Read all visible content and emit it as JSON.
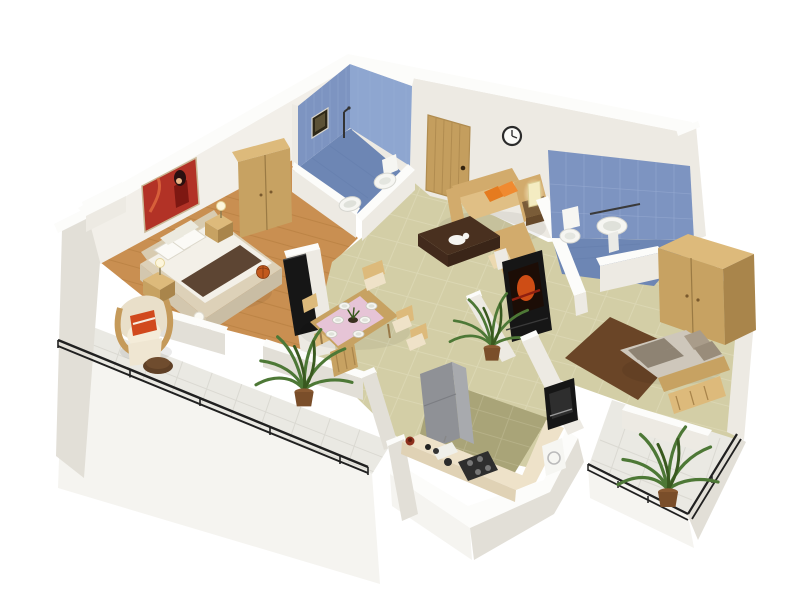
{
  "meta": {
    "type": "3d-isometric-floor-plan-render",
    "subject": "two-bedroom apartment 3D floor plan with balconies",
    "background": "#ffffff",
    "view": "isometric-from-south-east"
  },
  "palette": {
    "wall_top": "#fcfcfa",
    "wall_face": "#f2efe9",
    "wall_light": "#edeae3",
    "wall_mid": "#e2dfd7",
    "slab": "#f5f4f0",
    "blue_wall": "#7d94c1",
    "blue_wall_light": "#8ea6d0",
    "blue_floor": "#6d86b4",
    "blue_tile_line": "#9db0d6",
    "wood_floor": "#c98f51",
    "wood_line": "#b27c3e",
    "tile_floor": "#d3cea6",
    "tile_line": "#dfdbb9",
    "kitchen_floor": "#a9a478",
    "kitchen_line": "#b9b48c",
    "balcony_floor": "#eae9e3",
    "balcony_line": "#d8d6cf",
    "wood_furniture": "#c7a262",
    "wood_furniture_light": "#ddba7b",
    "wood_furniture_dark": "#a9854b",
    "door_wood": "#c49e5e",
    "sofa": "#d2ab6c",
    "sofa_light": "#e0bf85",
    "cream": "#efe2c8",
    "orange": "#e57b1f",
    "dark_table": "#49301f",
    "tv_black": "#161616",
    "tv_screen": "#e25417",
    "bed_linen": "#f3f0e8",
    "bed_runner": "#5d4533",
    "bed2_mattress": "#cec7bb",
    "bed2_cushion": "#8e8373",
    "rug_brown": "#6a4527",
    "plant_green": "#4d7836",
    "plant_dark": "#39591f",
    "railing": "#202020",
    "fridge_gray": "#8f9196",
    "counter_top": "#eee2c9",
    "white_fixture": "#f6f6f2",
    "poster_red": "#b23226",
    "pink_cloth": "#e6c4d6",
    "glow": "#fdf6dc"
  },
  "rooms": [
    {
      "id": "master-bedroom",
      "floor": "wooden-planks",
      "objects": [
        "double-bed",
        "white-linen",
        "brown-bed-runner",
        "four-pillows",
        "nightstand-left",
        "nightstand-right",
        "ball-table-lamps",
        "double-door-wardrobe",
        "red-wall-art",
        "tv-panel",
        "basketball",
        "floor-ball-lamp"
      ]
    },
    {
      "id": "bathroom-1",
      "walls": "blue-tile",
      "objects": [
        "toilet",
        "wash-basin-on-half-wall",
        "shower-fixture",
        "small-window",
        "half-walls"
      ]
    },
    {
      "id": "entrance-hall",
      "objects": [
        "wooden-entry-door",
        "wall-clock"
      ]
    },
    {
      "id": "living-room",
      "objects": [
        "l-shaped-beige-sofa",
        "two-orange-cushions",
        "cream-cushion",
        "dark-coffee-table",
        "white-cat-on-table",
        "side-table",
        "glowing-lamp",
        "black-tv-unit-orange-screen",
        "houseplant"
      ]
    },
    {
      "id": "dining-room",
      "objects": [
        "wooden-dining-table",
        "pink-table-runner",
        "six-chairs",
        "six-place-settings",
        "dark-centerpiece",
        "houseplant"
      ]
    },
    {
      "id": "kitchen",
      "floor": "olive-tile",
      "objects": [
        "gray-refrigerator",
        "l-shaped-counter",
        "gas-hob",
        "sink-board",
        "black-oven-microwave",
        "washing-machine",
        "red-pot",
        "bottles"
      ]
    },
    {
      "id": "bathroom-2",
      "walls": "blue-tile",
      "objects": [
        "toilet",
        "wall-mounted-basin",
        "towel-rail",
        "half-wall"
      ]
    },
    {
      "id": "bedroom-2",
      "floor": "beige-tile",
      "objects": [
        "double-bed-taupe",
        "two-long-cushions",
        "pillows",
        "wood-bench",
        "double-door-wardrobe",
        "brown-rug",
        "half-wall"
      ]
    },
    {
      "id": "balcony-1",
      "floor": "light-tile",
      "objects": [
        "black-railing",
        "cream-armchair",
        "orange-blanket",
        "round-stool"
      ]
    },
    {
      "id": "balcony-2",
      "floor": "light-tile",
      "objects": [
        "black-railing",
        "potted-palm"
      ]
    }
  ]
}
